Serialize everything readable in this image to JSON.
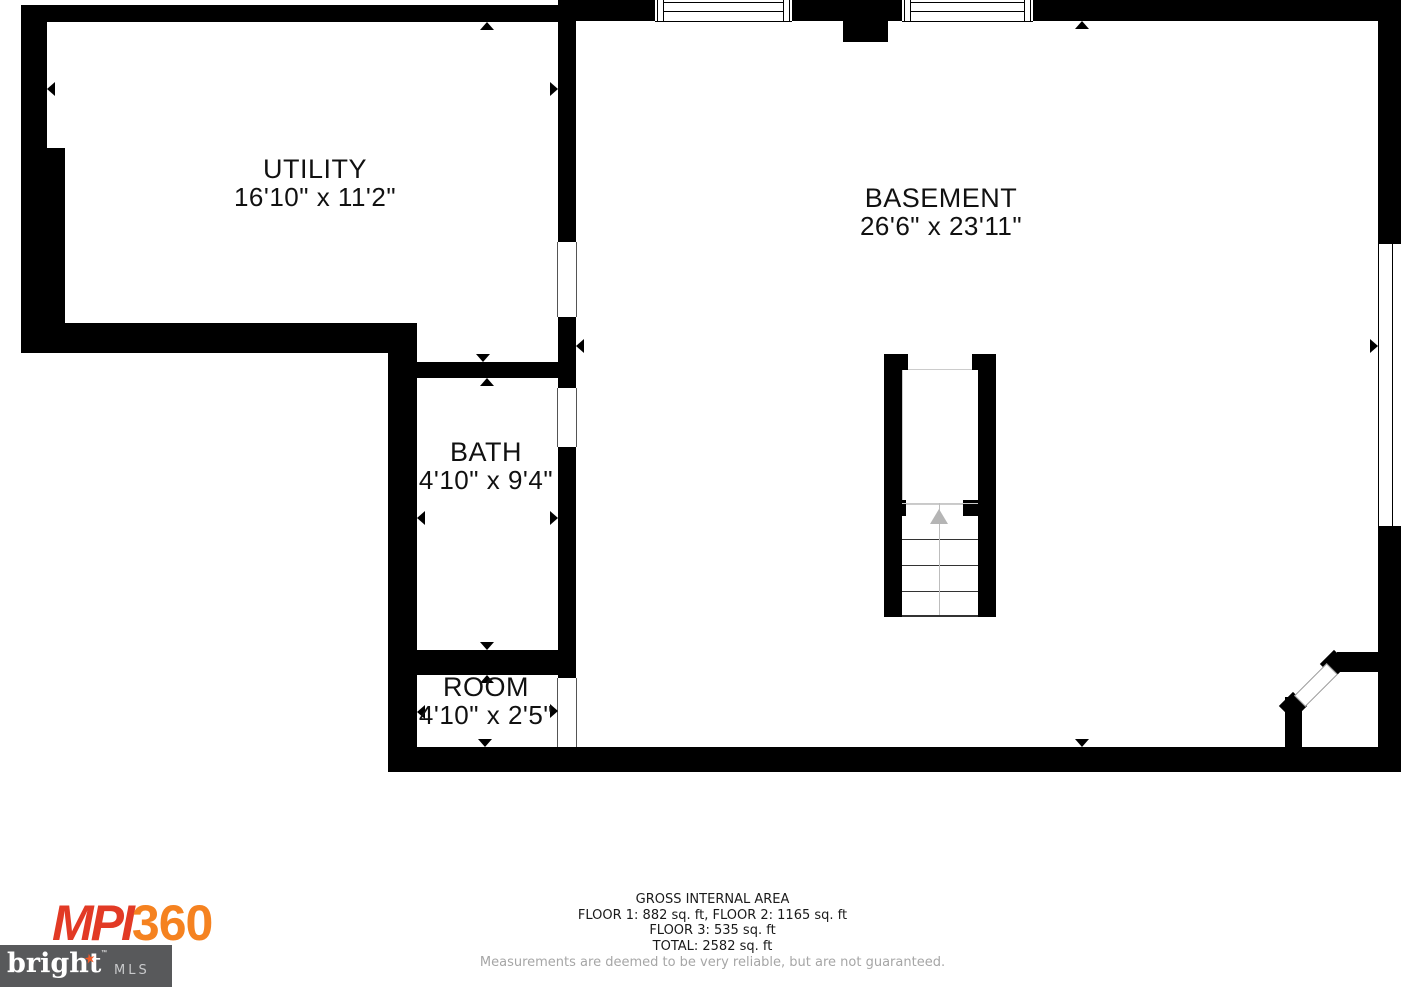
{
  "plan": {
    "rooms": {
      "utility": {
        "name": "UTILITY",
        "dims": "16'10\" x 11'2\""
      },
      "basement": {
        "name": "BASEMENT",
        "dims": "26'6\" x 23'11\""
      },
      "bath": {
        "name": "BATH",
        "dims": "4'10\" x 9'4\""
      },
      "room": {
        "name": "ROOM",
        "dims": "4'10\" x 2'5\""
      }
    },
    "features": [
      "staircase-with-up-arrow",
      "two-top-windows",
      "right-side-window",
      "corner-angled-door"
    ]
  },
  "footer": {
    "title": "GROSS INTERNAL AREA",
    "line1": "FLOOR 1: 882 sq. ft, FLOOR 2: 1165 sq. ft",
    "line2": "FLOOR 3: 535 sq. ft",
    "line3": "TOTAL: 2582 sq. ft",
    "disclaimer": "Measurements are deemed to be very reliable, but are not guaranteed."
  },
  "logos": {
    "mpi360": {
      "part1": "MPI",
      "part2": "360"
    },
    "bright_mls": {
      "name": "bright",
      "tm": "™",
      "star": "★",
      "suffix": "MLS"
    }
  },
  "colors": {
    "wall": "#000000",
    "mpi_red": "#e23a25",
    "mpi_orange": "#f58220",
    "bright_box": "#58595b",
    "note_gray": "#a6a6a6",
    "stair_gray": "#b5b5b5"
  }
}
